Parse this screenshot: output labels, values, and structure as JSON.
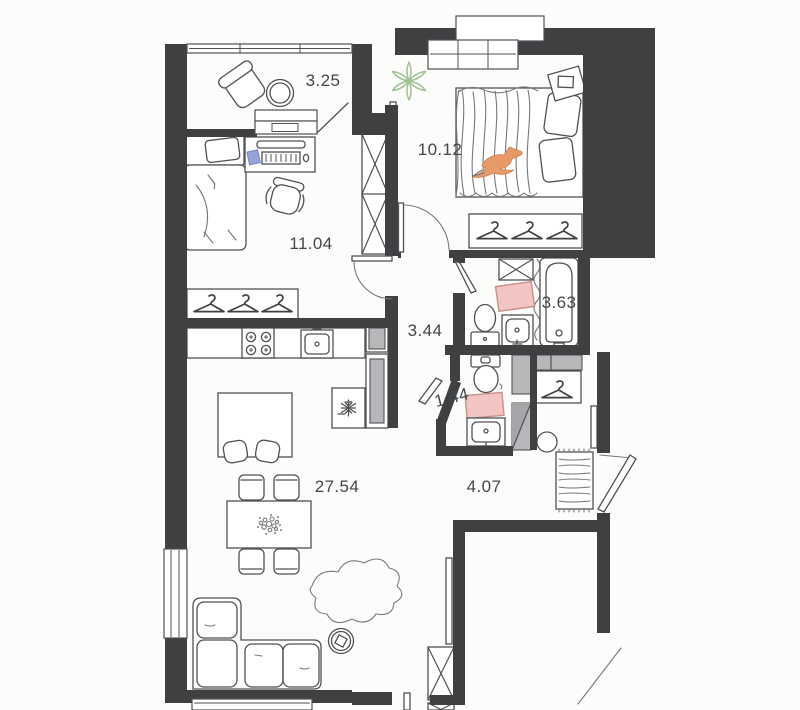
{
  "plan": {
    "type": "apartment-floor-plan",
    "rooms": [
      {
        "id": "balcony",
        "area": "3.25",
        "fixtures": [
          "armchair",
          "round-table",
          "balcony-door"
        ]
      },
      {
        "id": "bedroom-right",
        "area": "10.12",
        "fixtures": [
          "double-bed",
          "pillows",
          "bird-decor",
          "plant",
          "mirror",
          "bedside-table",
          "wardrobe-hangers",
          "window"
        ]
      },
      {
        "id": "bedroom-left",
        "area": "11.04",
        "fixtures": [
          "single-bed",
          "desk",
          "laptop",
          "office-chair",
          "wardrobe-hangers",
          "tall-x-wardrobe"
        ]
      },
      {
        "id": "hallway",
        "area": "3.44",
        "fixtures": [
          "doors"
        ]
      },
      {
        "id": "bathroom",
        "area": "3.63",
        "fixtures": [
          "bathtub",
          "shower-curtain",
          "washing-machine",
          "toilet",
          "sink",
          "pink-mat"
        ]
      },
      {
        "id": "wc",
        "area": "1.44",
        "fixtures": [
          "toilet",
          "sink",
          "pink-mat"
        ]
      },
      {
        "id": "living-kitchen",
        "area": "27.54",
        "fixtures": [
          "kitchen-counter",
          "stove",
          "kitchen-sink",
          "fridge",
          "tall-cabinet",
          "kitchen-island",
          "island-chairs",
          "dining-table",
          "dining-chairs",
          "flower-centerpiece",
          "rug",
          "sofa",
          "side-table",
          "x-wardrobe",
          "mirror"
        ]
      },
      {
        "id": "entry",
        "area": "4.07",
        "fixtures": [
          "hanger-closet",
          "shoe-cabinet",
          "duct-shafts",
          "pouf",
          "striped-doormat",
          "mirror",
          "entrance-door"
        ]
      }
    ],
    "colors": {
      "wall": "#3f4042",
      "furniture_line": "#4e5155",
      "sketch_line": "#76797d",
      "label_text": "#43474c",
      "mat_pink_fill": "#f2c5c2",
      "mat_pink_stroke": "#c98f8c",
      "plant_green": "#a0c292",
      "bird_orange": "#e59a68",
      "cabinet_gray": "#b7b7b9",
      "notepad_blue": "#96a5d8",
      "background": "#fcfcfb"
    }
  }
}
